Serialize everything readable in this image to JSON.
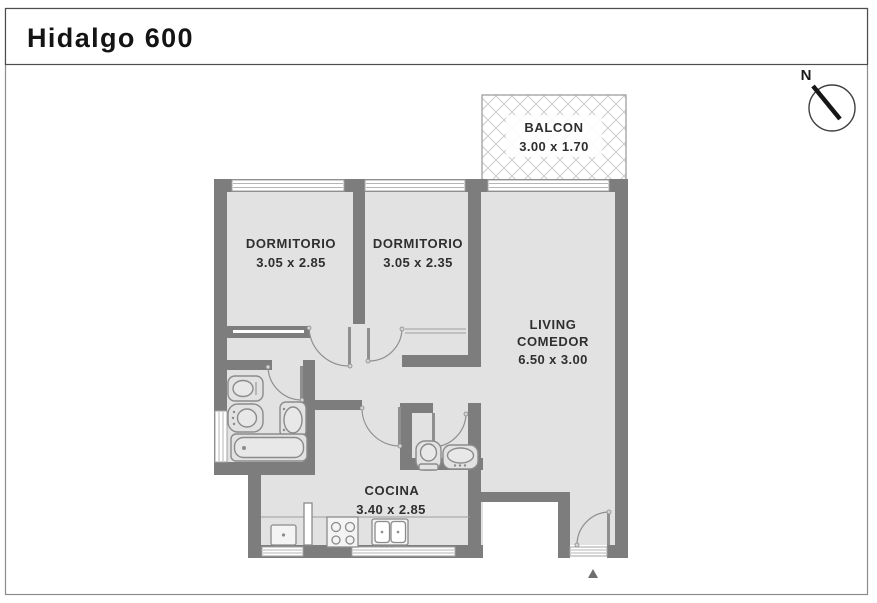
{
  "title": "Hidalgo 600",
  "compass": {
    "north_label": "N"
  },
  "rooms": {
    "balcony": {
      "name": "BALCON",
      "dims": "3.00 x 1.70"
    },
    "bedroom1": {
      "name": "DORMITORIO",
      "dims": "3.05 x 2.85"
    },
    "bedroom2": {
      "name": "DORMITORIO",
      "dims": "3.05 x 2.35"
    },
    "living": {
      "name_line1": "LIVING",
      "name_line2": "COMEDOR",
      "dims": "6.50 x 3.00"
    },
    "kitchen": {
      "name": "COCINA",
      "dims": "3.40 x 2.85"
    }
  },
  "colors": {
    "wall": "#7d7d7d",
    "floor": "#e2e2e2",
    "fixture_outline": "#8b8b8b",
    "text": "#2f2f2f",
    "page_border": "#8c8c8c",
    "header_border": "#4d4d4d",
    "hatch": "#cccccc"
  }
}
